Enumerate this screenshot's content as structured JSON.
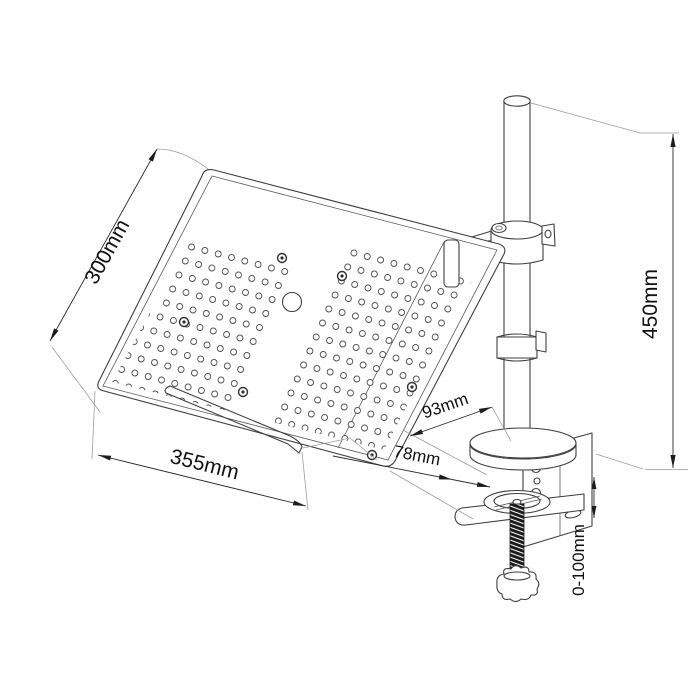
{
  "drawing": {
    "dimensions": {
      "tray_depth": "300mm",
      "tray_width": "355mm",
      "pole_height": "450mm",
      "clamp_plate_depth": "93mm",
      "clamp_throat_depth": "78mm",
      "clamp_opening_range": "0-100mm"
    }
  }
}
